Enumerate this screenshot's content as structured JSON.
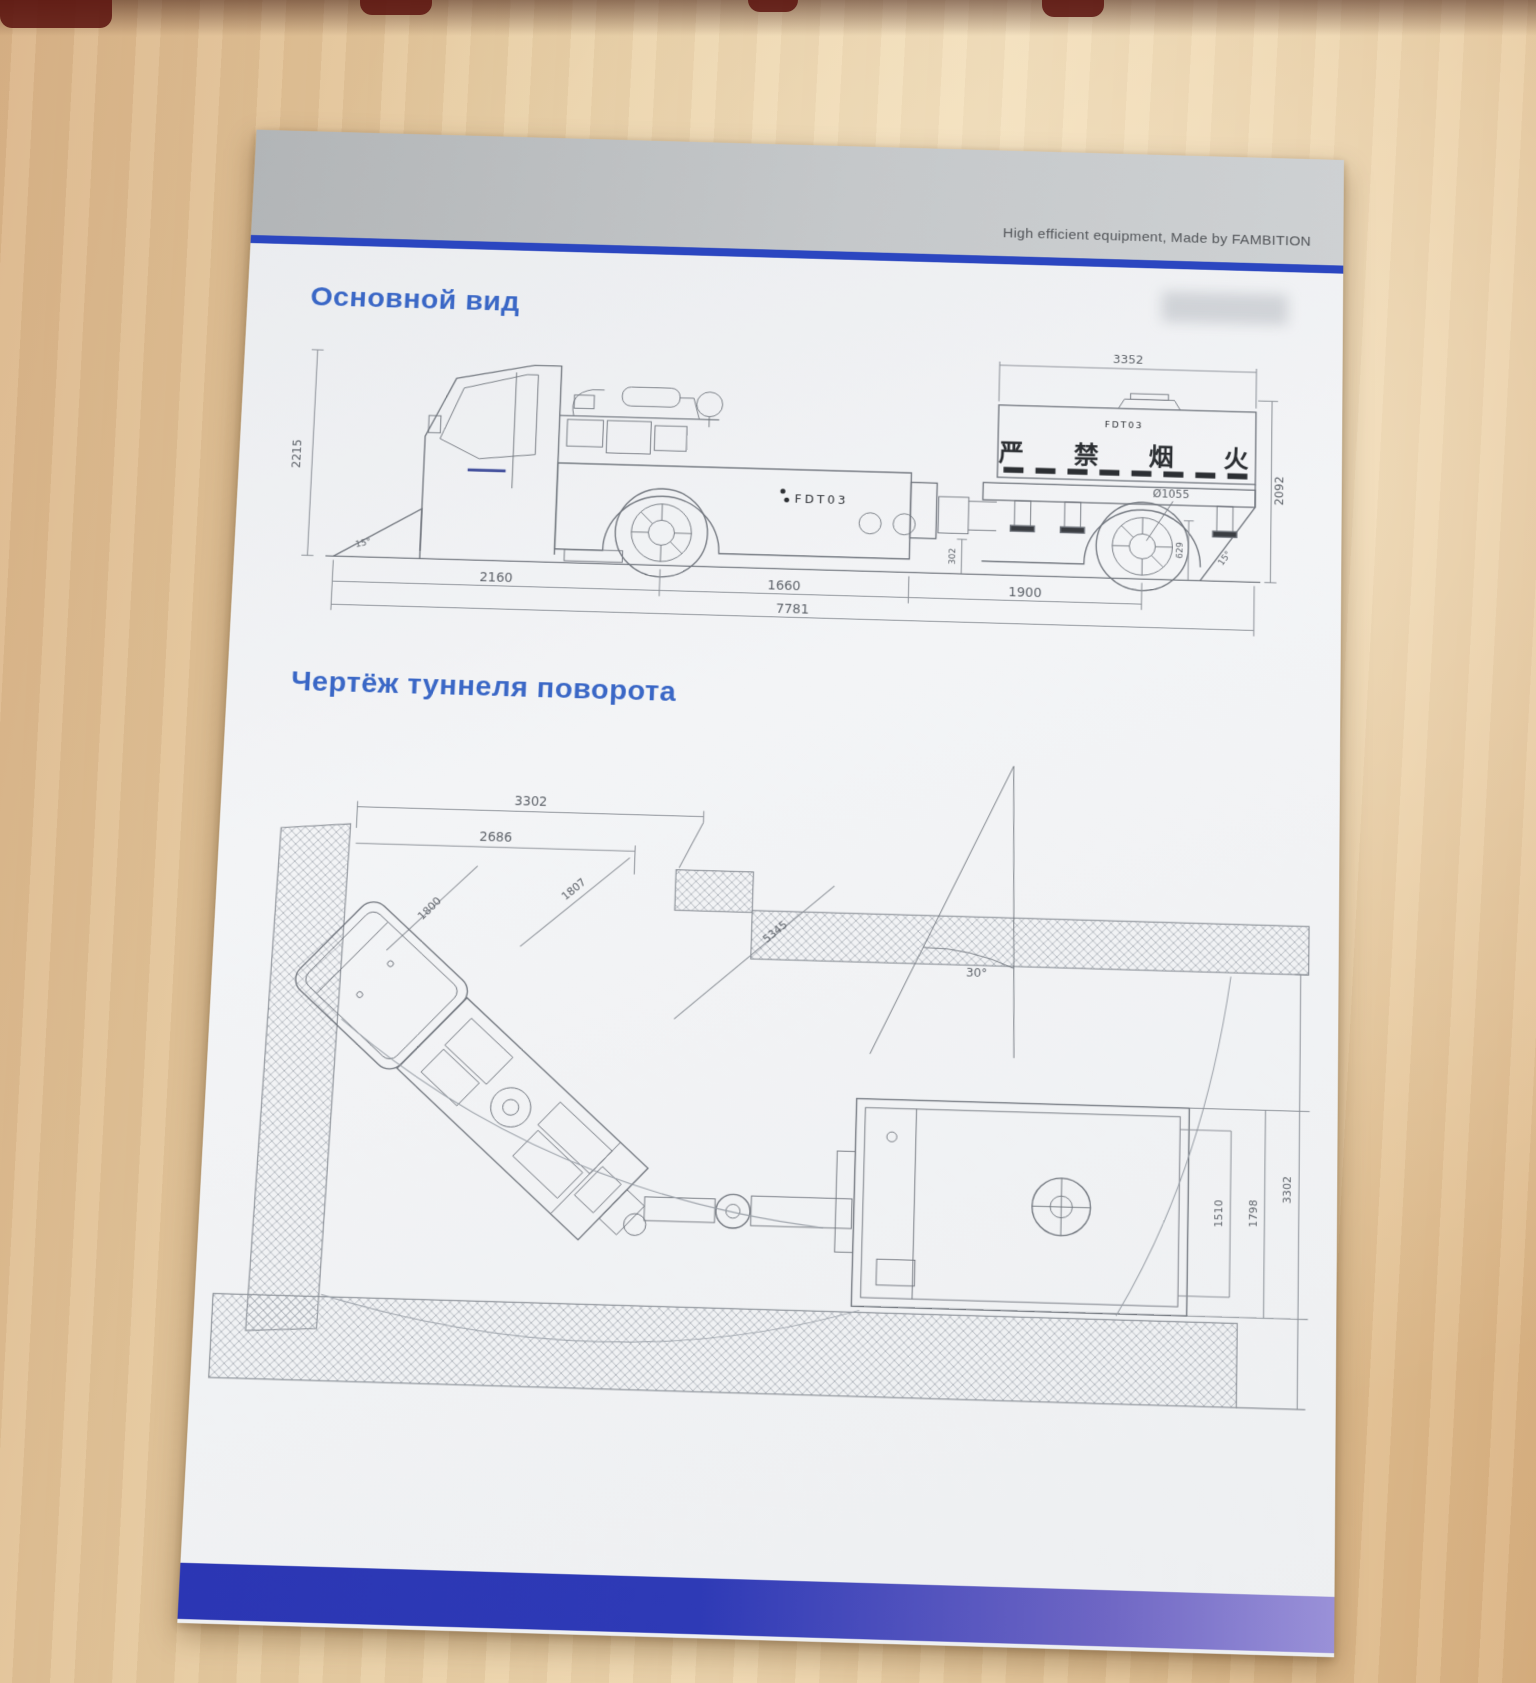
{
  "colors": {
    "header_rule_blue": "#2b46c0",
    "footer_stripe_blue": "#2e3ab6",
    "title_blue": "#3a67c6"
  },
  "header": {
    "tagline": "High efficient equipment, Made by FAMBITION"
  },
  "main_view": {
    "title": "Основной вид",
    "model_label": "FDT03",
    "tank_model_label": "FDT03",
    "tank_warning": "严 禁 烟 火",
    "dims": {
      "overall_height": "2215",
      "front_angle": "15°",
      "tank_length": "3352",
      "rear_height": "2092",
      "wheel_diameter": "Ø1055",
      "ground_clearance": "302",
      "rear_axle_height": "629",
      "departure_angle": "15°",
      "front_section": "2160",
      "mid_section": "1660",
      "rear_section": "1900",
      "overall_length": "7781"
    }
  },
  "turning_view": {
    "title": "Чертёж туннеля поворота",
    "dims": {
      "outer_span": "3302",
      "inner_span": "2686",
      "machine_width": "1800",
      "radius_inner": "1807",
      "radius_outer": "5345",
      "turn_angle": "30°",
      "trailer_inner_width": "1510",
      "trailer_outer_width": "1798",
      "tunnel_width": "3302"
    }
  }
}
